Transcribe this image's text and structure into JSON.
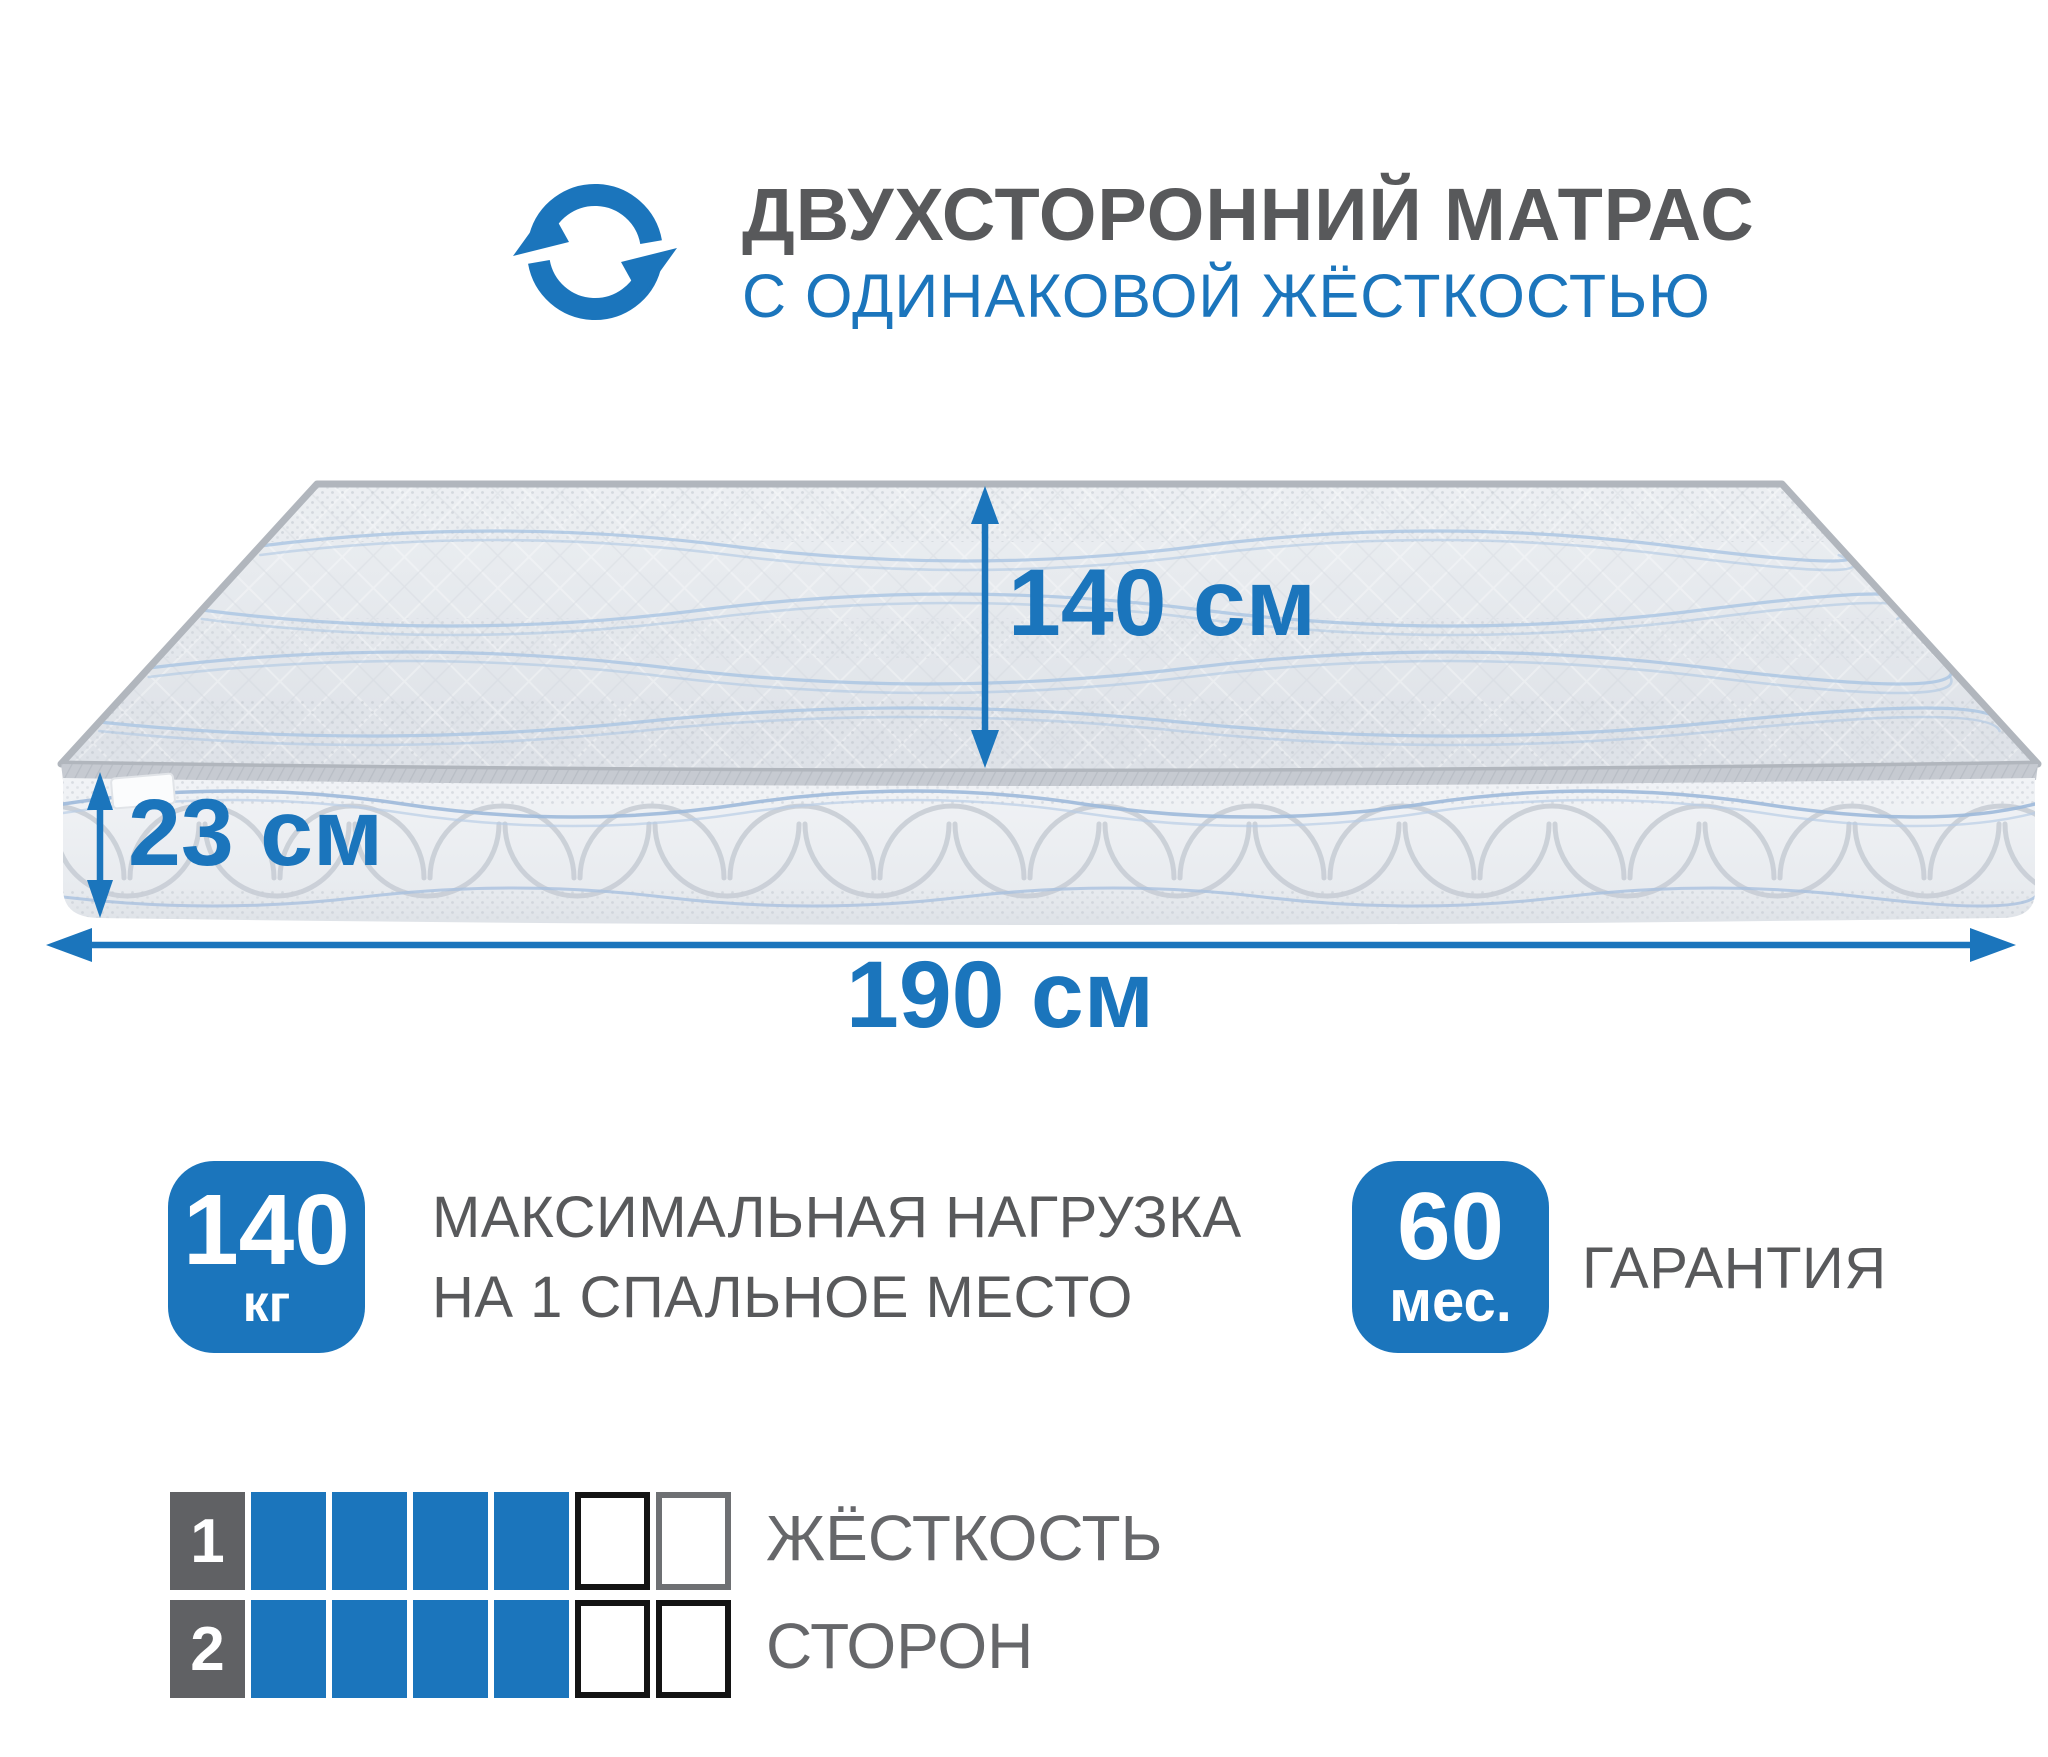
{
  "colors": {
    "accent": "#1b75bc",
    "title_gray": "#58595b",
    "scale_number_bg": "#606164"
  },
  "header": {
    "icon": "rotate-arrows-icon",
    "title_line1": "ДВУХСТОРОННИЙ МАТРАС",
    "title_line2": "С ОДИНАКОВОЙ ЖЁСТКОСТЬЮ"
  },
  "dimensions": {
    "width_label": "140 см",
    "height_label": "23 см",
    "length_label": "190 см"
  },
  "badges": {
    "max_load": {
      "value": "140",
      "unit": "кг",
      "label_line1": "МАКСИМАЛЬНАЯ НАГРУЗКА",
      "label_line2": "НА 1 СПАЛЬНОЕ МЕСТО"
    },
    "warranty": {
      "value": "60",
      "unit": "мес.",
      "label": "ГАРАНТИЯ"
    }
  },
  "firmness_scale": {
    "label_line1": "ЖЁСТКОСТЬ",
    "label_line2": "СТОРОН",
    "total_cells": 6,
    "rows": [
      {
        "side": "1",
        "filled": 4,
        "empty_border_colors": [
          "#141414",
          "#6e7073"
        ]
      },
      {
        "side": "2",
        "filled": 4,
        "empty_border_colors": [
          "#141414",
          "#141414"
        ]
      }
    ]
  }
}
